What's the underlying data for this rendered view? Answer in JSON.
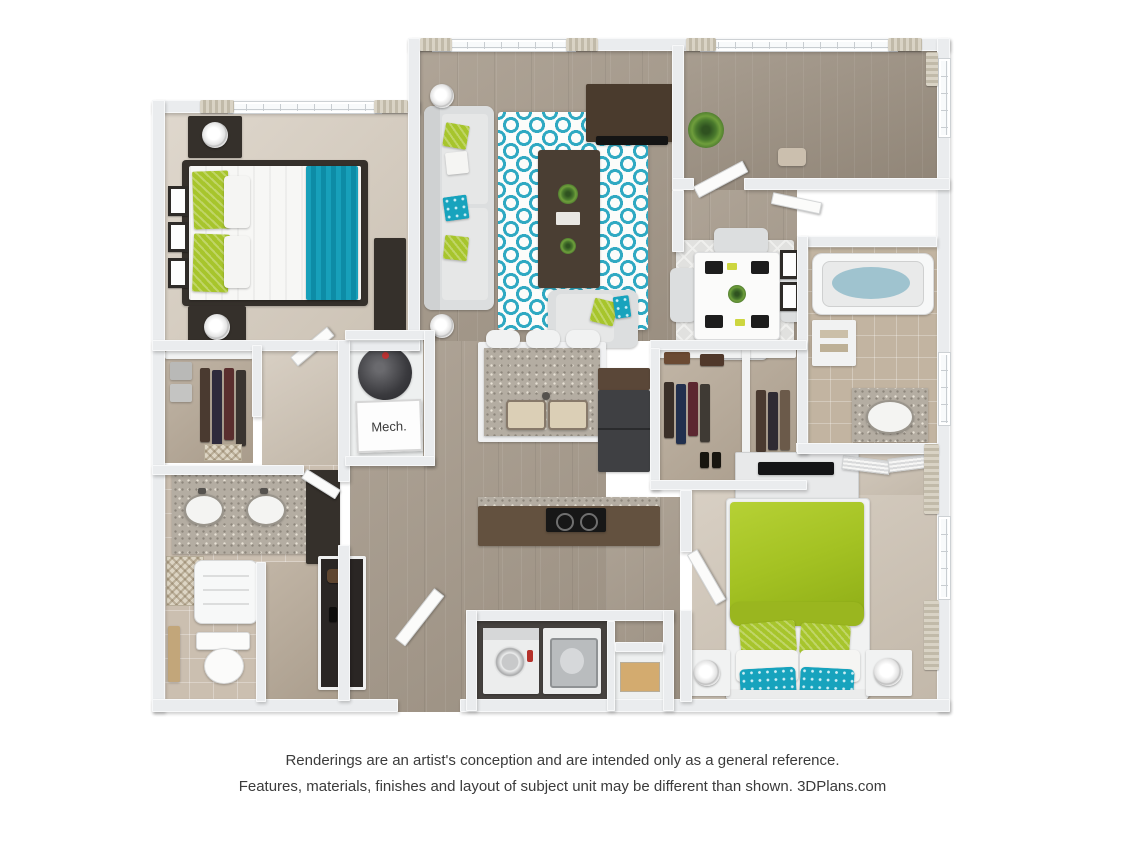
{
  "labels": {
    "mech_room": "Mech."
  },
  "disclaimer": {
    "line1": "Renderings are an artist's conception and are intended only as a general reference.",
    "line2": "Features, materials, finishes and layout of subject unit may be different than shown. 3DPlans.com"
  },
  "palette": {
    "background": "#ffffff",
    "text": "#3b3b3b",
    "wall": "#eaecee",
    "wood_floor": "#a69a8b",
    "carpet_bedroom1": "#d4cabc",
    "carpet_bedroom2": "#cdc2b3",
    "tile_bath": "#cbbfb0",
    "accent_teal": "#17a0ba",
    "accent_green": "#a7c52c",
    "dark_furniture": "#35302b",
    "granite_counter": "#b4ada2",
    "kitchen_counter_brown": "#63513f"
  }
}
